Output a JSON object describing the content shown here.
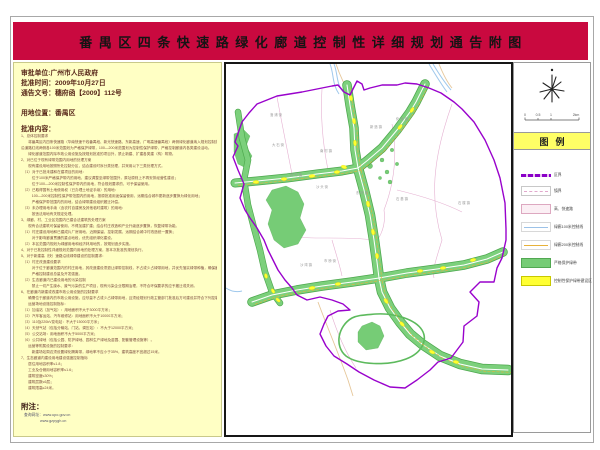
{
  "title": "番禺区四条快速路绿化廊道控制性详细规划通告附图",
  "colors": {
    "banner": "#c9093f",
    "panel_bg": "#ffffc4",
    "legend_band": "#ffff66",
    "district_boundary": "#9902cc",
    "green_belt": "#76cc76",
    "construction_zone": "#ffff2e",
    "river": "#9fc8ec",
    "road": "#e6c79a",
    "town_line": "#e2a8cc"
  },
  "info": {
    "approval_unit": "审批单位:广州市人民政府",
    "approval_time": "批准时间：2009年10月27日",
    "notice_no": "通告文号：穗府函【2009】112号",
    "location": "用地位置：番禺区",
    "content_header": "批准内容：",
    "body_lines": [
      "1、总体控制要求",
      "　　将番禺区内四条快速路（华南快速干线番禺段、新光快速路、东新高速、广明高速番禺段）两侧绿化廊道纳入规划控制范围，",
      "沿道路红线两侧各100米范围划为严格保护绿带，100—200米范围划为控制性保护绿带，严格控制廊道内各类建设活动。",
      "　　绿化廊道范围内除市政公用设施及按规划批准的项目外，禁止新建、扩建各类建（构）筑物。",
      "2、对已位于现有绿带范围内用地的处理方案",
      "　　现有建设用地按照所处控制分区，结合建设时序分类处理，并采用以下三类处理方式。",
      "　（1）对于已批未建和在建项目的用地：",
      "　　　位于100米严格保护带内的用地，建议调整至绿带范围外，原址原则上不再安排经营性建设；",
      "　　　位于100—200米控制性保护带内的用地，符合规划要求的，可予保留使用。",
      "　（2）已取得国有土地使用权（已办理土地证手续）的用地：",
      "　　　100—200米控制性保护带范围内的用地，按原批准用途保留使用，远期结合城市更新逐步置换为绿化用地；",
      "　　　严格保护带范围内的用地，结合绿带建设组织搬迁补偿。",
      "　（3）未办理用地手续（含农村自建房及其他临时建筑）的用地：",
      "　　　按违法用地有关规定处理。",
      "3、绿廊、村、工业区范围内已建合法建筑的处理方案",
      "　　现有合法建筑可保留使用，不得加建扩建；结合村庄改造和产业升级逐步置换，恢复绿带功能。",
      "　（1）村庄建设用地和已建成片厂房用地，近期保留、控制发展，远期结合城中村改造统一置换；",
      "　　　对于影响廊道贯通的重点地段，优先组织绿化建设。",
      "　（2）本区范围内规划为绿廊用地和经济林用地的，按规划逐步实施。",
      "4、对于已批控制性详细规划范围内用地的处理方案，按本次批准的规划执行。",
      "5、对于新建高（快）速路沿线绿带建设的控制要求：",
      "　（1）村庄改造建设要求",
      "　　　对于位于廊道范围内的村庄用地，其改造建设须退让绿带控制线，不占或少占绿带用地，并优先落实绿带种植，确保廊道贯通；",
      "　　　严格控制建设总量及开发强度。",
      "　（2）生态廊道内已建设用地的污染控制",
      "　　　禁止一切产生废水、废气污染的生产项目，现有污染企业限期治理，不符合环保要求的应予搬迁或关闭。",
      "6、在廊道内新建或改建市政公用设施的控制要求",
      "　　确需位于廊道内的市政公用设施，应尽量不占或少占绿带用地，且须经规划行政主管部门批准后方可建设并符合下列控制指标。",
      "　　运营场地设施控制指标：",
      "　（1）加油站（加气站）：用地面积不大于3000平方米；",
      "　（2）汽车客运站、汽车维修站：用地面积不大于10000平方米；",
      "　（3）110及220kV变电站：不大于15000平方米；",
      "　（4）天然气站（包括分输站、门站、调压站）：不大于12000平方米；",
      "　（5）公交站场：用地面积不大于5000平方米；",
      "　（6）公共绿地（包括公园、防护绿地、园林生产绿地及苗圃、配套管理设施等）。",
      "　　运营等附属设施的控制要求：",
      "　　　新建场站周边须设置绿化隔离带，绿地率不应小于35%，建筑高度不宜超过15米。",
      "7、生态廊道内建设用地建设强度控制指标",
      "　　居住用地容积率≤1.8；",
      "　　工业及仓储用地容积率≤1.6；",
      "　　建筑密度≤30%；",
      "　　建筑层数≤6层；",
      "　　建筑限高≤24米。"
    ],
    "note_header": "附注：",
    "note_lines": [
      "查询网址：www.upo.gov.cn",
      "www.gzpygh.cn"
    ]
  },
  "map": {
    "labels": [
      {
        "text": "洛 浦 街",
        "x": 50,
        "y": 52
      },
      {
        "text": "大 石 街",
        "x": 52,
        "y": 82
      },
      {
        "text": "南 村 镇",
        "x": 100,
        "y": 88
      },
      {
        "text": "新 造 镇",
        "x": 150,
        "y": 64
      },
      {
        "text": "化 龙 镇",
        "x": 176,
        "y": 56
      },
      {
        "text": "石 楼 镇",
        "x": 238,
        "y": 140
      },
      {
        "text": "石 基 镇",
        "x": 176,
        "y": 136
      },
      {
        "text": "东 环 街",
        "x": 136,
        "y": 130
      },
      {
        "text": "沙 头 街",
        "x": 96,
        "y": 124
      },
      {
        "text": "钟 村 镇",
        "x": 70,
        "y": 112
      },
      {
        "text": "市 桥 街",
        "x": 104,
        "y": 198
      },
      {
        "text": "沙 湾 镇",
        "x": 80,
        "y": 202
      }
    ]
  },
  "side": {
    "legend_title": "图例",
    "scale_ticks": [
      "0",
      "0.5",
      "1",
      "2km"
    ],
    "legend_items": [
      {
        "label": "区界",
        "swatch": "district-boundary"
      },
      {
        "label": "镇界",
        "swatch": "town-boundary"
      },
      {
        "label": "高、快速路",
        "swatch": "expressway"
      },
      {
        "label": "绿廊100米控制线",
        "swatch": "line-100m"
      },
      {
        "label": "绿廊200米控制线",
        "swatch": "line-200m"
      },
      {
        "label": "严格保护绿带",
        "swatch": "strict-green"
      },
      {
        "label": "控制性保护绿带建设区",
        "swatch": "control-green"
      }
    ]
  }
}
